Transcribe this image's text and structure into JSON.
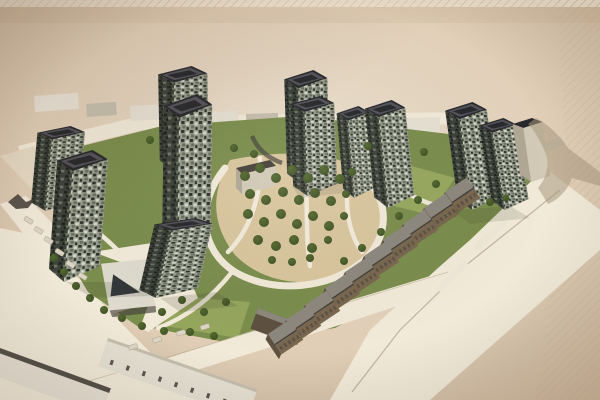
{
  "meta": {
    "title": "Aerial rendering of a residential masterplan",
    "media": "photograph of a printed architectural visualization on beige paper"
  },
  "scene": {
    "caption": "Photograph of an architectural rendering: aerial view of a residential development with eleven dark speckled high-rise towers arranged around a central orchard park with looping paths, a light mid-rise slab on the east, rows of brown townhouses along the south-east street, a white pavilion with a pyramidal roof, surface parking and existing low city blocks along the west and south edges, and a long cast shadow falling to the east on the paper background",
    "counts": {
      "dark_towers": 11,
      "light_midrise_slabs": 1,
      "townhouse_blocks": 10,
      "pavilions": 1,
      "existing_buildings": 3,
      "context_buildings": 10,
      "park_trees": 56,
      "parked_cars": 10
    },
    "site_features": [
      "central orchard park with looping paths",
      "perimeter streets with crosswalks",
      "surface parking rows",
      "hatched paper texture at top and right edges",
      "cast shadows falling east"
    ]
  },
  "palette": {
    "paper-center": "#efe5d3",
    "paper-mid": "#e0cdb5",
    "paper-edge": "#ccb69c",
    "hatch-line": "#c4ae92",
    "road-light": "#f2ead9",
    "road-mid": "#e6dac4",
    "curb": "#b5a68e",
    "context-side": "#c6bfae",
    "grass": "#7b8e4d",
    "grass-light": "#9cad62",
    "grove-ground": "#d9c69e",
    "tree-dark": "#394e24",
    "tree-mid": "#55692e",
    "tower-face": "#9aa08f",
    "speck-dark": "#2c312a",
    "speck-light": "#d6dacb",
    "speck-mid": "#697061",
    "tower-side": "#3d423a",
    "side-speck": "#1e231c",
    "side-speck2": "#6f7667",
    "roof-dark": "#28292c",
    "roof-inner": "#54525a",
    "slab-light": "#d2cab7",
    "slab-side": "#b0a794",
    "townhouse-face": "#79674f",
    "townhouse-side": "#5f5140",
    "townhouse-roof": "#8d887e",
    "existing-face": "#e7e1d4",
    "existing-dark": "#45413a",
    "pavilion-body": "#dedace",
    "pavilion-dark": "#33373b",
    "shadow": "#a8977e",
    "car": "#dcd6c8"
  }
}
